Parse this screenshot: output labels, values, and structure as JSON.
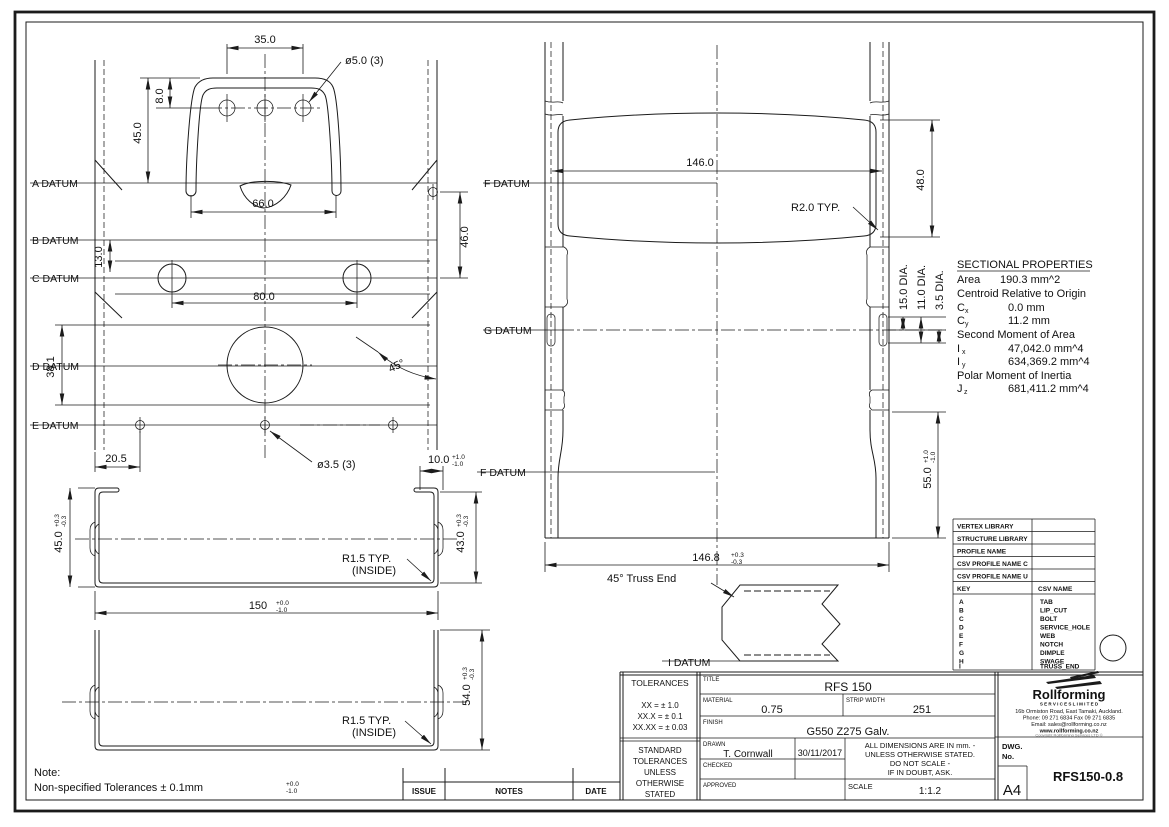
{
  "drawing": {
    "flat_view": {
      "datums": [
        "A DATUM",
        "B DATUM",
        "C DATUM",
        "D DATUM",
        "E DATUM"
      ],
      "dim_hole_spacing": "35.0",
      "hole_callout_top": "ø5.0 (3)",
      "dim_tab_hole_offset": "8.0",
      "dim_tab_height": "45.0",
      "dim_tab_width": "66.0",
      "dim_bc": "13.0",
      "dim_bolt_spacing": "80.0",
      "dim_ac": "46.0",
      "dim_service_band": "38.1",
      "dim_edge_hole": "20.5",
      "hole_callout_bottom": "ø3.5 (3)",
      "angle_chamfer": "45°"
    },
    "formed_view": {
      "datum_f_top": "F DATUM",
      "datum_g": "G DATUM",
      "datum_f_bottom": "F DATUM",
      "dim_swage_width": "146.0",
      "dim_swage_height": "48.0",
      "radius_callout": "R2.0 TYP.",
      "dia_outer": "15.0 DIA.",
      "dia_mid": "11.0 DIA.",
      "dia_inner": "3.5 DIA.",
      "dim_lip": {
        "v": "10.0",
        "p": "+1.0",
        "m": "-1.0"
      },
      "dim_bottom_h": {
        "v": "55.0",
        "p": "+1.0",
        "m": "-1.0"
      },
      "dim_overall_w": {
        "v": "146.8",
        "p": "+0.3",
        "m": "-0.3"
      }
    },
    "truss_detail": {
      "label": "45° Truss End",
      "datum_i": "I DATUM"
    },
    "section_views": {
      "dim_height_left": {
        "v": "45.0",
        "p": "+0.3",
        "m": "-0.3"
      },
      "dim_height_right": {
        "v": "43.0",
        "p": "+0.3",
        "m": "-0.3"
      },
      "dim_width": {
        "v": "150",
        "p": "+0.0",
        "m": "-1.0"
      },
      "dim_height_deep": {
        "v": "54.0",
        "p": "+0.3",
        "m": "-0.3"
      },
      "radius_callout_1": "R1.5 TYP.",
      "radius_callout_2": "(INSIDE)"
    },
    "sectional_properties": {
      "title": "SECTIONAL PROPERTIES",
      "area_label": "Area",
      "area_value": "190.3 mm^2",
      "centroid_heading": "Centroid Relative to Origin",
      "cx_sym": "C",
      "cx_sub": "x",
      "cx_value": "0.0 mm",
      "cy_sym": "C",
      "cy_sub": "y",
      "cy_value": "11.2 mm",
      "smoa_heading": "Second Moment of Area",
      "ix_sym": "I",
      "ix_sub": "x",
      "ix_value": "47,042.0 mm^4",
      "iy_sym": "I",
      "iy_sub": "y",
      "iy_value": "634,369.2 mm^4",
      "polar_heading": "Polar Moment of Inertia",
      "jz_sym": "J",
      "jz_sub": "z",
      "jz_value": "681,411.2 mm^4"
    },
    "note": {
      "heading": "Note:",
      "text": "Non-specified Tolerances ± 0.1mm",
      "p": "+0.0",
      "m": "-1.0"
    }
  },
  "vertex_table": {
    "rows": [
      "VERTEX LIBRARY",
      "STRUCTURE LIBRARY",
      "PROFILE NAME",
      "CSV PROFILE NAME C",
      "CSV PROFILE NAME U"
    ],
    "key_header": "KEY",
    "name_header": "CSV NAME",
    "keys": [
      "A",
      "B",
      "C",
      "D",
      "E",
      "F",
      "G",
      "H",
      "I"
    ],
    "names": [
      "TAB",
      "LIP_CUT",
      "BOLT",
      "SERVICE_HOLE",
      "WEB",
      "NOTCH",
      "DIMPLE",
      "SWAGE",
      "TRUSS_END"
    ]
  },
  "issue_strip": {
    "issue": "ISSUE",
    "notes": "NOTES",
    "date": "DATE"
  },
  "title_block": {
    "tolerances_header": "TOLERANCES",
    "tol_lines": [
      "XX  =  ± 1.0",
      "XX.X  =  ± 0.1",
      "XX.XX  =  ± 0.03"
    ],
    "standard_lines": [
      "STANDARD",
      "TOLERANCES",
      "UNLESS",
      "OTHERWISE",
      "STATED"
    ],
    "title_label": "TITLE",
    "title_value": "RFS 150",
    "material_label": "MATERIAL",
    "material_value": "0.75",
    "strip_width_label": "STRIP WIDTH",
    "strip_width_value": "251",
    "finish_label": "FINISH",
    "finish_value": "G550 Z275 Galv.",
    "drawn_label": "DRAWN",
    "drawn_value": "T. Cornwall",
    "drawn_date": "30/11/2017",
    "checked_label": "CHECKED",
    "approved_label": "APPROVED",
    "dims_note_lines": [
      "ALL DIMENSIONS ARE IN mm. -",
      "UNLESS OTHERWISE STATED.",
      "DO NOT SCALE -",
      "IF IN DOUBT, ASK."
    ],
    "scale_label": "SCALE",
    "scale_value": "1:1.2",
    "dwg_label_1": "DWG.",
    "dwg_label_2": "No.",
    "dwg_value": "RFS150-0.8",
    "sheet_size": "A4"
  },
  "logo": {
    "name": "Rollforming",
    "subtitle": "S E R V I C E S   L I M I T E D",
    "address": "16b Ormiston Road, East Tamaki, Auckland.",
    "phone": "Phone: 09 271 6834  Fax 09 271 6835",
    "email": "Email: sales@rollforming.co.nz",
    "web": "www.rollforming.co.nz",
    "copyright": "Copyright Rollforming Services LTD ©"
  }
}
